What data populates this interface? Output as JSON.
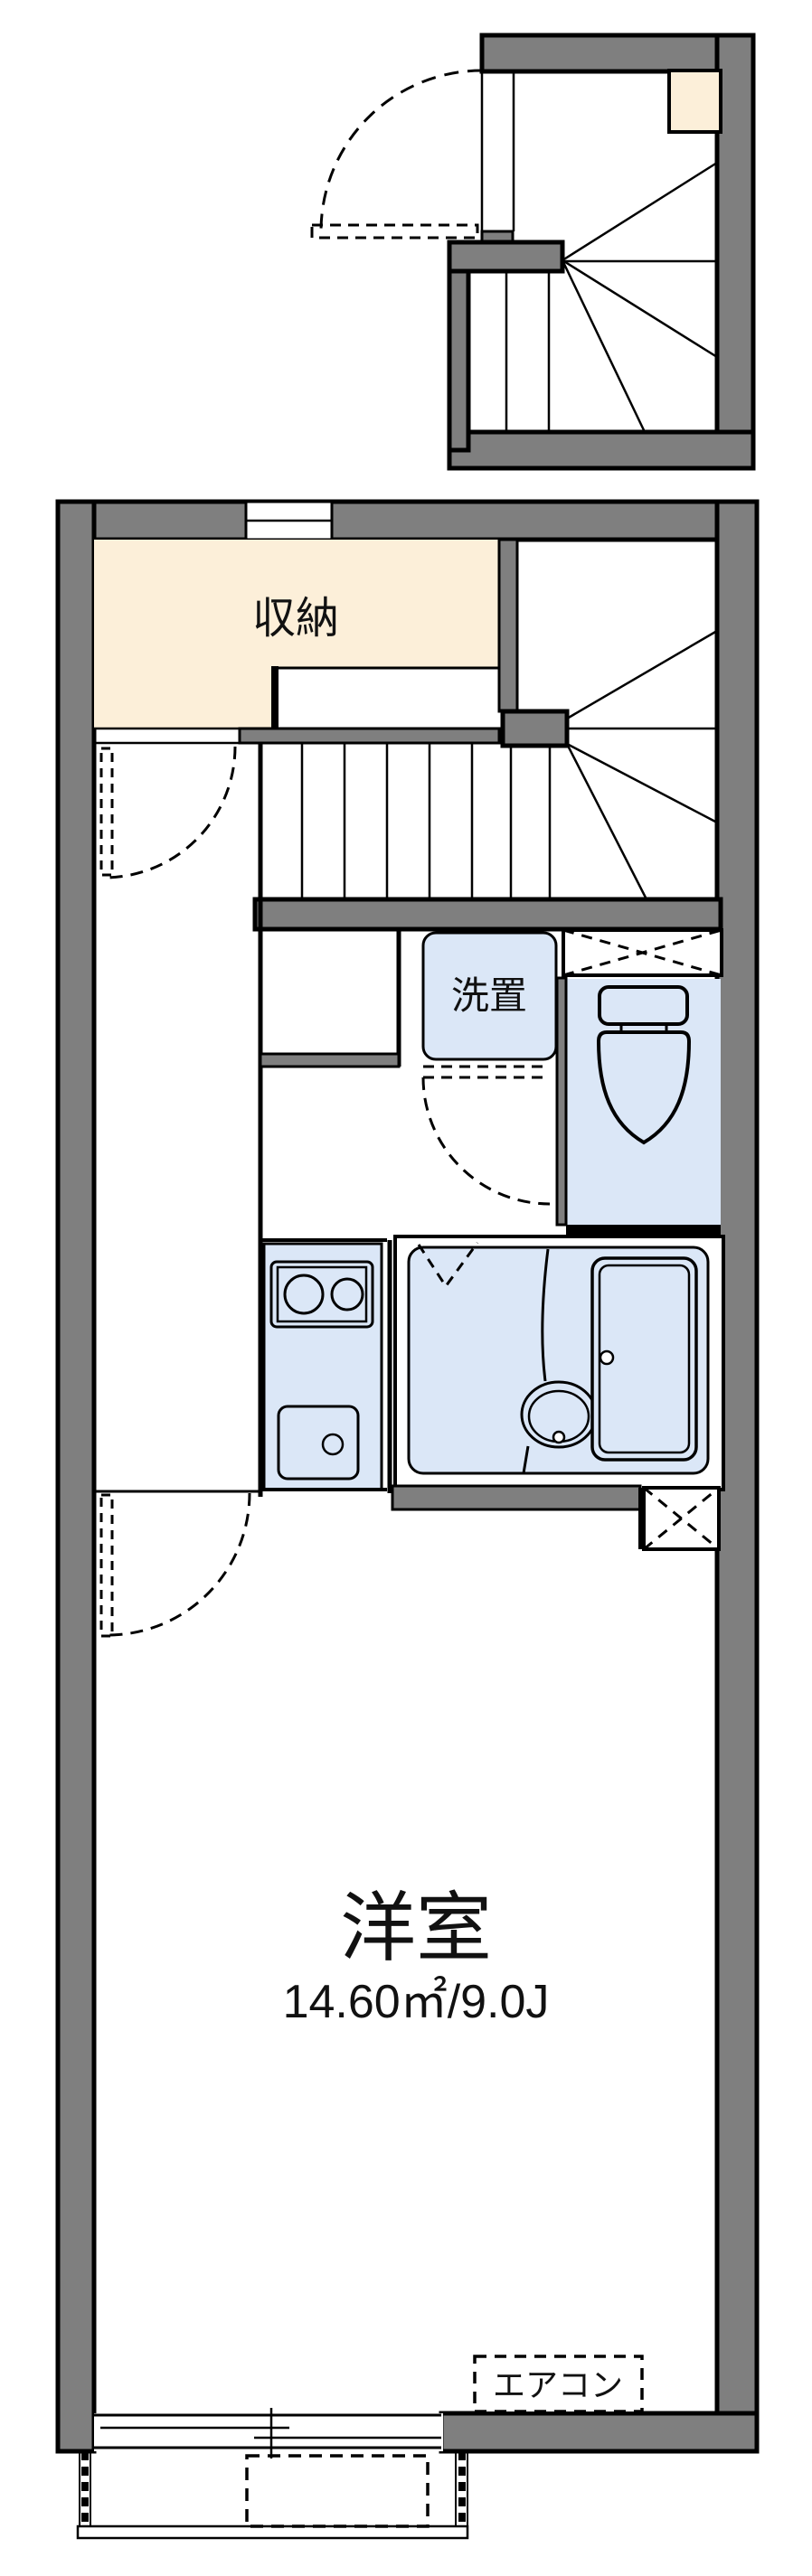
{
  "document": {
    "kind": "apartment floor plan",
    "floors": [
      "entrance / winder staircase structure",
      "main dwelling floor"
    ]
  },
  "labels": {
    "closet": "収納",
    "laundry": "洗置",
    "room": "洋室",
    "room_area": "14.60㎡/9.0J",
    "aircon": "エアコン"
  },
  "rooms": [
    {
      "id": "closet",
      "label": "収納",
      "fill": "#fcefd9"
    },
    {
      "id": "laundry",
      "label": "洗置",
      "fill": "#dbe7f7"
    },
    {
      "id": "toilet",
      "label": "",
      "fill": "#dbe7f7"
    },
    {
      "id": "kitchen",
      "label": "",
      "fill": "#dbe7f7"
    },
    {
      "id": "bathroom",
      "label": "",
      "fill": "#dbe7f7"
    },
    {
      "id": "western-room",
      "label": "洋室",
      "area_label": "14.60㎡/9.0J",
      "fill": "#ffffff"
    }
  ],
  "colors": {
    "wall": "#7f7f7f",
    "outline": "#000000",
    "closet_fill": "#fcefd9",
    "wet_area_fill": "#dbe7f7",
    "background": "#ffffff",
    "text": "#111111"
  }
}
